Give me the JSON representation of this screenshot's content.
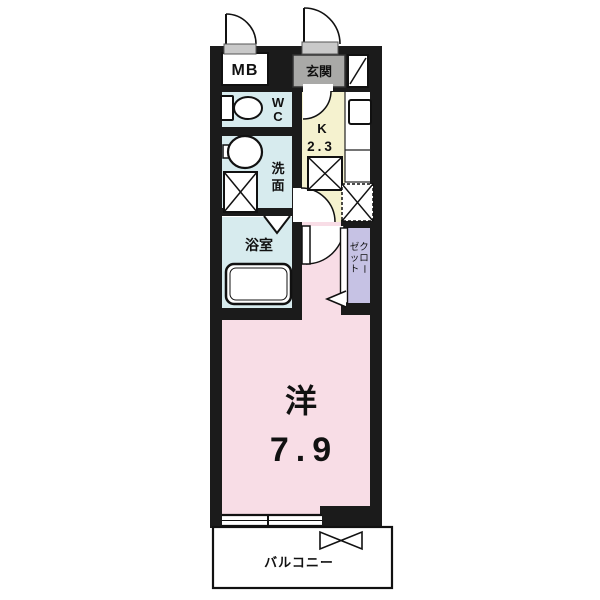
{
  "plan": {
    "type": "apartment-floor-plan",
    "rooms": {
      "mb": {
        "label": "MB"
      },
      "entrance": {
        "label": "玄関"
      },
      "wc": {
        "label": "WC"
      },
      "washroom": {
        "label": "洗面"
      },
      "bathroom": {
        "label": "浴室"
      },
      "kitchen": {
        "label": "K",
        "size": "2.3"
      },
      "closet": {
        "label": "クローゼット"
      },
      "main_room": {
        "label": "洋",
        "size": "7.9"
      },
      "balcony": {
        "label": "バルコニー"
      }
    },
    "colors": {
      "wet_rooms": "#d7ebee",
      "kitchen": "#f5f2cf",
      "main_room": "#f8dde6",
      "closet": "#c6c2e4",
      "entrance": "#a9a9a7",
      "doorway": "#c9c9c9",
      "wall": "#1b1b1b"
    }
  }
}
